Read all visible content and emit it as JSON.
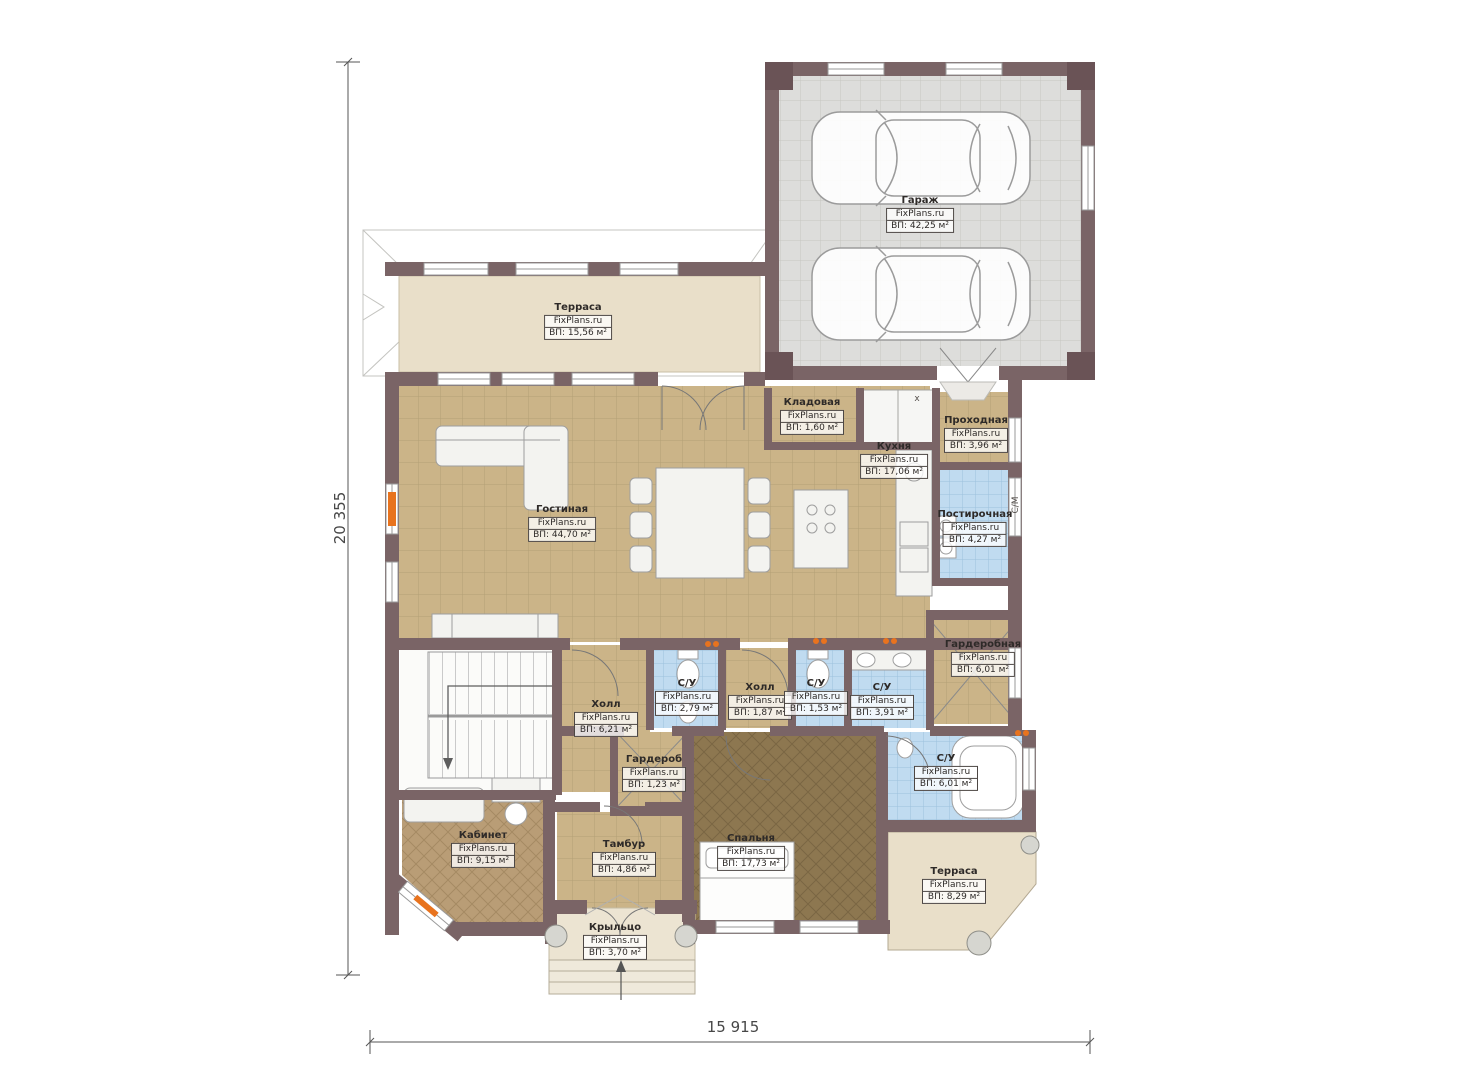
{
  "plan": {
    "brand": "FixPlans.ru",
    "dimensions": {
      "left": "20 355",
      "bottom": "15 915"
    },
    "annotations": {
      "washer": "С/М",
      "closet_mark": "х"
    },
    "colors": {
      "wall": "#7a6466",
      "pillar": "#6a5356",
      "floor_tan": "#cbb488",
      "floor_garage": "#dddddb",
      "floor_wet": "#c0dbf0",
      "floor_bedroom": "#8d7750",
      "floor_office": "#b99d76",
      "floor_terrace": "#e9dfc9",
      "accent_orange": "#e8731e"
    },
    "rooms": [
      {
        "name": "Гараж",
        "area": "ВП: 42,25 м²"
      },
      {
        "name": "Терраса",
        "area": "ВП: 15,56 м²"
      },
      {
        "name": "Кладовая",
        "area": "ВП: 1,60 м²"
      },
      {
        "name": "Кухня",
        "area": "ВП: 17,06 м²"
      },
      {
        "name": "Проходная",
        "area": "ВП: 3,96 м²"
      },
      {
        "name": "Гостиная",
        "area": "ВП: 44,70 м²"
      },
      {
        "name": "Постирочная",
        "area": "ВП: 4,27 м²"
      },
      {
        "name": "Гардеробная",
        "area": "ВП: 6,01 м²"
      },
      {
        "name": "С/У",
        "area": "ВП: 2,79 м²"
      },
      {
        "name": "Холл",
        "area": "ВП: 1,87 м²"
      },
      {
        "name": "С/У",
        "area": "ВП: 1,53 м²"
      },
      {
        "name": "С/У",
        "area": "ВП: 3,91 м²"
      },
      {
        "name": "Холл",
        "area": "ВП: 6,21 м²"
      },
      {
        "name": "Гардероб",
        "area": "ВП: 1,23 м²"
      },
      {
        "name": "Кабинет",
        "area": "ВП: 9,15 м²"
      },
      {
        "name": "Тамбур",
        "area": "ВП: 4,86 м²"
      },
      {
        "name": "Спальня",
        "area": "ВП: 17,73 м²"
      },
      {
        "name": "С/У",
        "area": "ВП: 6,01 м²"
      },
      {
        "name": "Терраса",
        "area": "ВП: 8,29 м²"
      },
      {
        "name": "Крыльцо",
        "area": "ВП: 3,70 м²"
      }
    ]
  }
}
